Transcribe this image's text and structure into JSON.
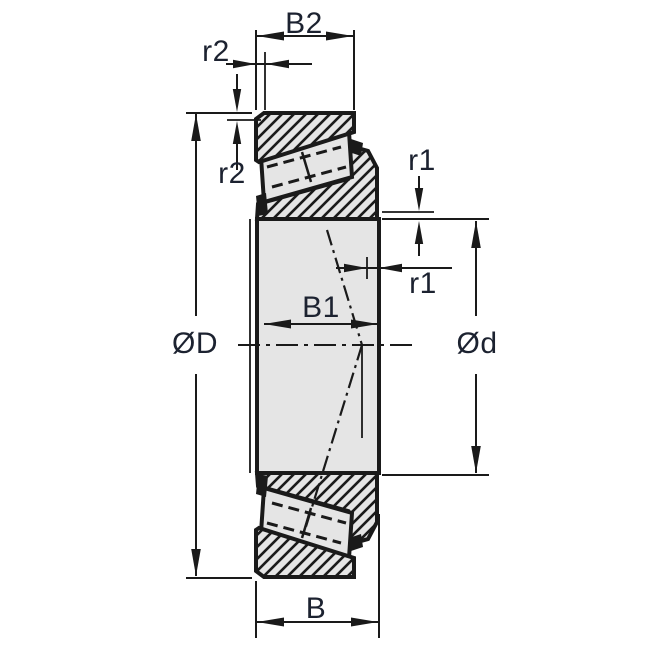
{
  "drawing": {
    "description": "Tapered roller bearing cross-section dimension drawing",
    "labels": {
      "b2": "B2",
      "r2_top": "r2",
      "r2_left": "r2",
      "r1_top": "r1",
      "r1_right": "r1",
      "b1": "B1",
      "outer_diameter": "ØD",
      "bore_diameter": "Ød",
      "b": "B"
    },
    "colors": {
      "line": "#1a1a1a",
      "label": "#1c2230",
      "section_fill": "#e5e5e5",
      "background": "#ffffff"
    }
  }
}
